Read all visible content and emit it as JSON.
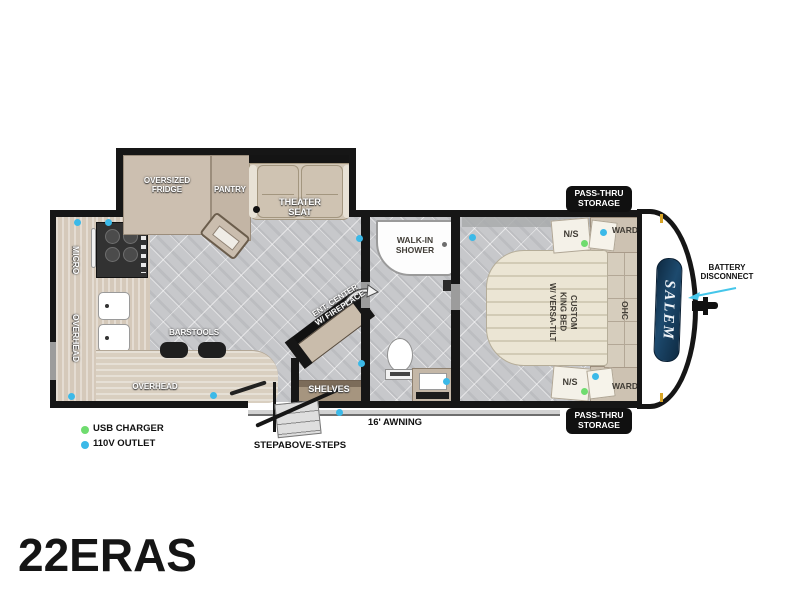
{
  "model": "22ERAS",
  "brand_logo": "SALEM",
  "slideout": {
    "fridge": "OVERSIZED\nFRIDGE",
    "pantry": "PANTRY",
    "theater": "THEATER\nSEAT"
  },
  "kitchen": {
    "micro": "MICRO",
    "overhead_wall": "OVERHEAD",
    "overhead_counter": "OVERHEAD",
    "barstools": "BARSTOOLS"
  },
  "living": {
    "ent_center": "ENT. CENTER\nW/ FIREPLACE",
    "shelves": "SHELVES"
  },
  "bath": {
    "shower": "WALK-IN\nSHOWER"
  },
  "bedroom": {
    "bed": "CUSTOM\nKING BED\nW/ VERSA-TILT",
    "ohc": "OHC",
    "ns_rear": "N/S",
    "ns_front": "N/S",
    "ward_rear": "WARD",
    "ward_front": "WARD"
  },
  "storage": {
    "pass_thru_rear": "PASS-THRU\nSTORAGE",
    "pass_thru_front": "PASS-THRU\nSTORAGE"
  },
  "exterior": {
    "battery": "BATTERY\nDISCONNECT",
    "awning": "16' AWNING",
    "steps": "STEPABOVE-STEPS"
  },
  "legend": {
    "usb": {
      "label": "USB CHARGER",
      "color": "#6fdc6f"
    },
    "outlet": {
      "label": "110V OUTLET",
      "color": "#3bb9e8"
    }
  },
  "colors": {
    "wall": "#161616",
    "floor_tile": "#c7c8cb",
    "cabinet_tan": "#c9bcac",
    "counter_wood": "#d9cfc0",
    "bed_cream": "#ebe5d4",
    "logo_navy": "#16344f",
    "arrow_cyan": "#45c6ea",
    "amber_light": "#d8a528"
  }
}
